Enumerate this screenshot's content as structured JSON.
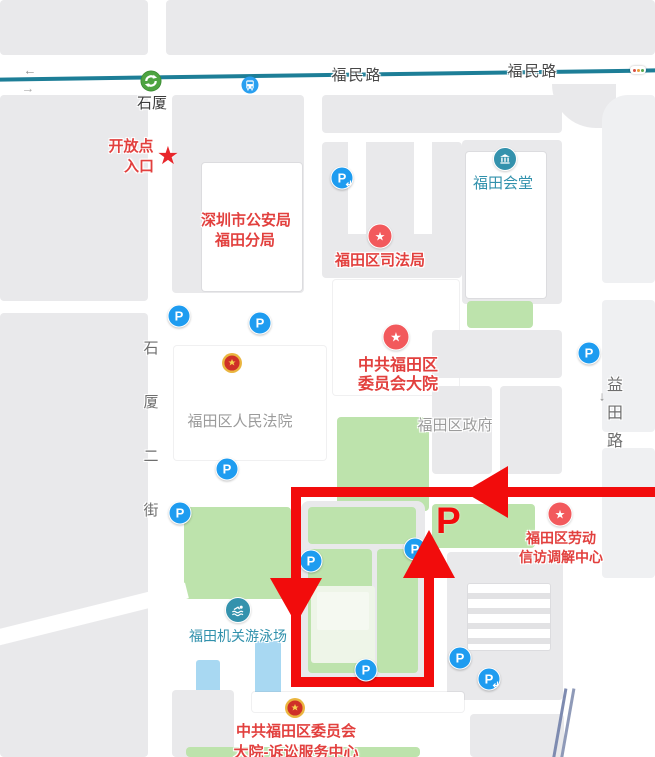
{
  "roads": {
    "fumin_1": "福民路",
    "fumin_2": "福民路",
    "shixia_chars": [
      "石",
      "厦",
      "二",
      "街"
    ],
    "yitian_chars": [
      "益",
      "田",
      "路"
    ],
    "oneway_left": "←",
    "oneway_right": "→",
    "yitian_arrow": "↓"
  },
  "transit": {
    "metro_station_label": "石厦"
  },
  "icons": {
    "parking_letter": "P",
    "star": "★"
  },
  "route_annotation": {
    "parking_label": "P",
    "entrance_line1": "开放点",
    "entrance_line2": "入口"
  },
  "pois": {
    "police_line1": "深圳市公安局",
    "police_line2": "福田分局",
    "justice_bureau": "福田区司法局",
    "futian_hall": "福田会堂",
    "committee_line1": "中共福田区",
    "committee_line2": "委员会大院",
    "court": "福田区人民法院",
    "government": "福田区政府",
    "labor_line1": "福田区劳动",
    "labor_line2": "信访调解中心",
    "swimming": "福田机关游泳场",
    "litigation_line1": "中共福田区委员会",
    "litigation_line2": "大院-诉讼服务中心"
  },
  "colors": {
    "route_red": "#f20c0c",
    "poi_text_red": "#e2403e",
    "teal_text": "#3191ac",
    "gray_text": "#9b9b9b",
    "parking_blue": "#1e9cf0",
    "metro_green": "#4ea441",
    "road_line_teal": "#1d7e97",
    "green_area": "#bde3ac",
    "emblem_gold": "#eab53f"
  }
}
